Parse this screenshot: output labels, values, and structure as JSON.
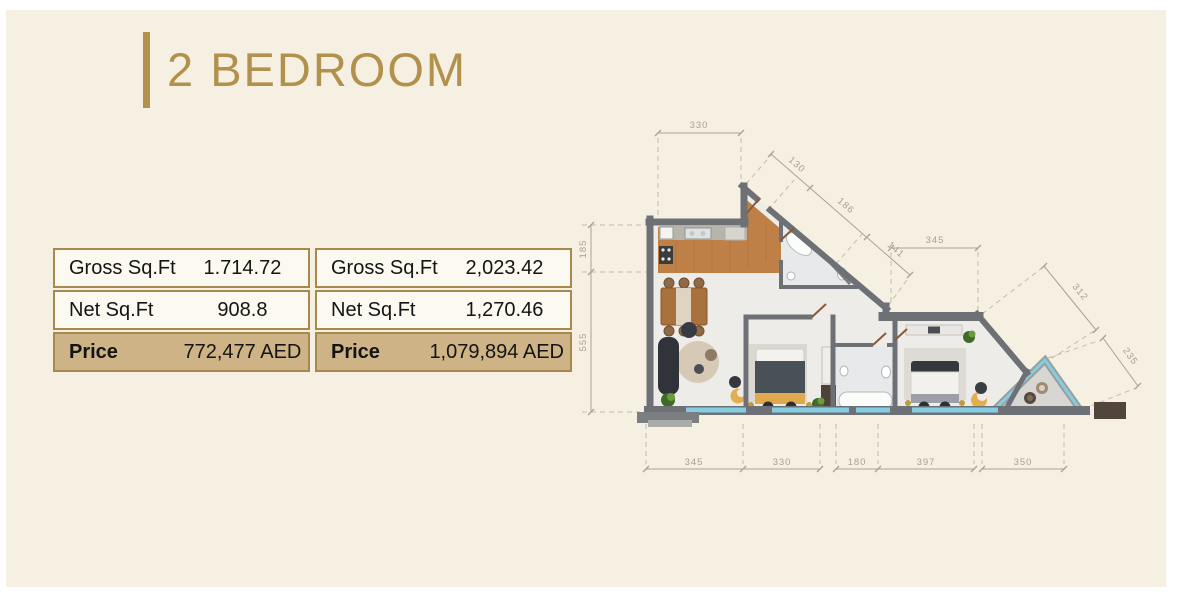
{
  "header": {
    "title": "2 BEDROOM",
    "accent_color": "#b2914c"
  },
  "units": [
    {
      "rows": [
        {
          "label": "Gross Sq.Ft",
          "value": "1.714.72"
        },
        {
          "label": "Net Sq.Ft",
          "value": "908.8"
        },
        {
          "label": "Price",
          "value": "772,477 AED"
        }
      ]
    },
    {
      "rows": [
        {
          "label": "Gross Sq.Ft",
          "value": "2,023.42"
        },
        {
          "label": "Net Sq.Ft",
          "value": "1,270.46"
        },
        {
          "label": "Price",
          "value": "1,079,894 AED"
        }
      ]
    }
  ],
  "floor_plan": {
    "dimensions": {
      "top": "330",
      "upper_diagonal": [
        "130",
        "186",
        "141"
      ],
      "mid_horizontal": "345",
      "right_diagonal": [
        "312",
        "235"
      ],
      "left_vertical": [
        "185",
        "555"
      ],
      "bottom": [
        "345",
        "330",
        "180",
        "397",
        "350"
      ]
    },
    "colors": {
      "panel_cream": "#f6f0e2",
      "accent_gold": "#b2914c",
      "price_row": "#cdb385",
      "table_border": "#a6894f",
      "wall_gray": "#6d7175",
      "wood_floor": "#be8046",
      "glazing_teal": "#85cde0",
      "dimension_gray": "#a7a195"
    }
  }
}
